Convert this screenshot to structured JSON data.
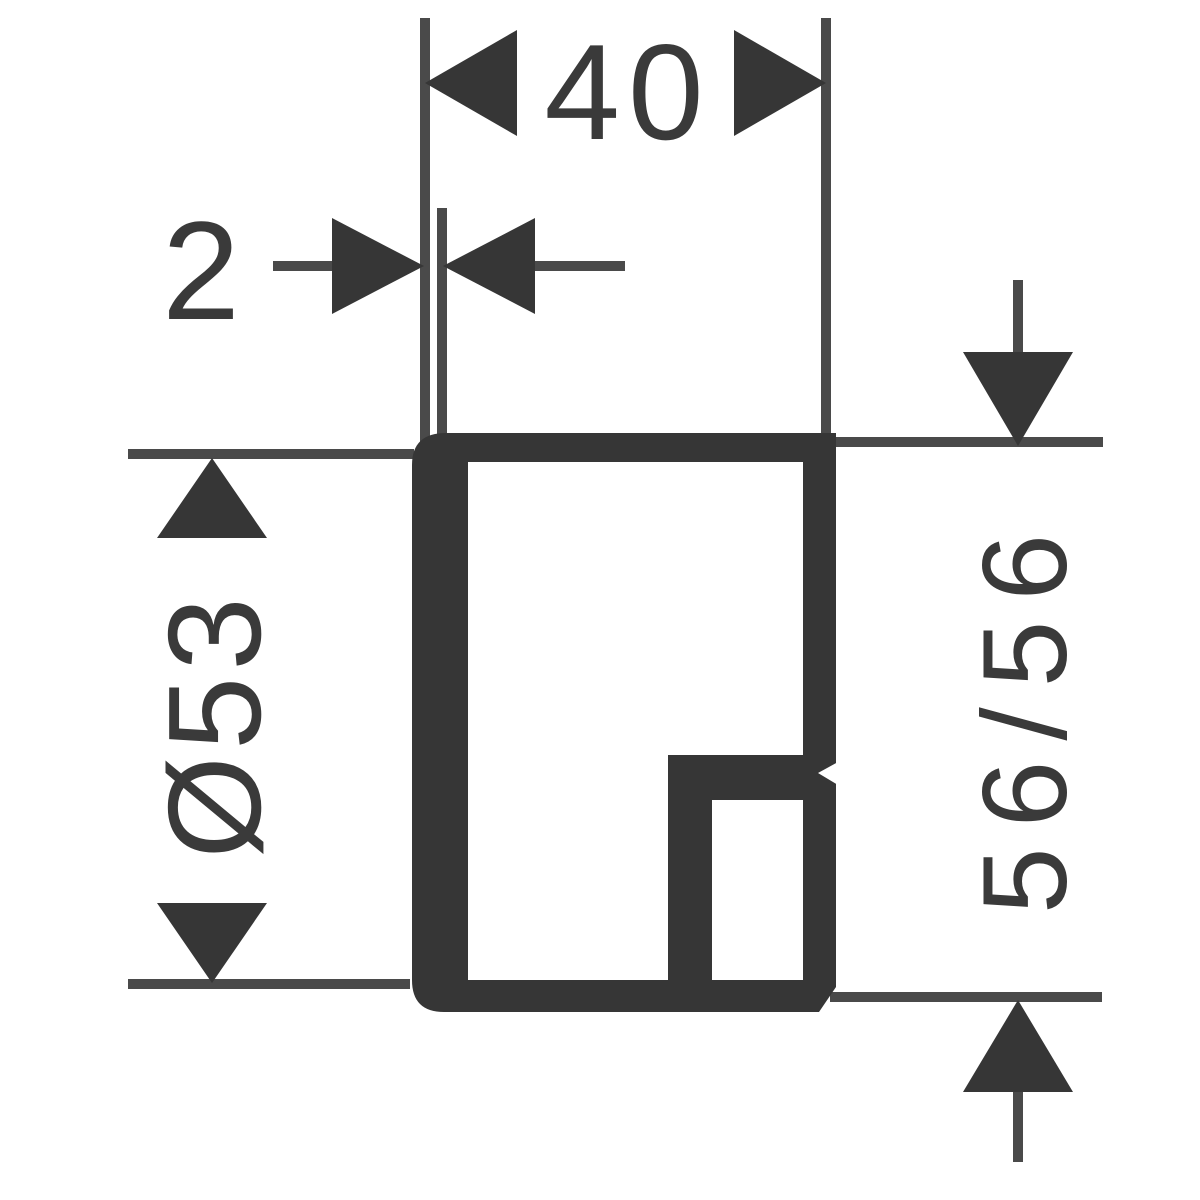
{
  "drawing_title": "Technical dimension drawing",
  "colors": {
    "background": "#ffffff",
    "shape": "#363636",
    "line": "#4a4a4a",
    "text": "#3a3a3a"
  },
  "dimensions": {
    "depth": {
      "label": "40"
    },
    "wall": {
      "label": "2"
    },
    "diameter": {
      "label": "Ø53"
    },
    "face": {
      "label": "56/56"
    }
  }
}
